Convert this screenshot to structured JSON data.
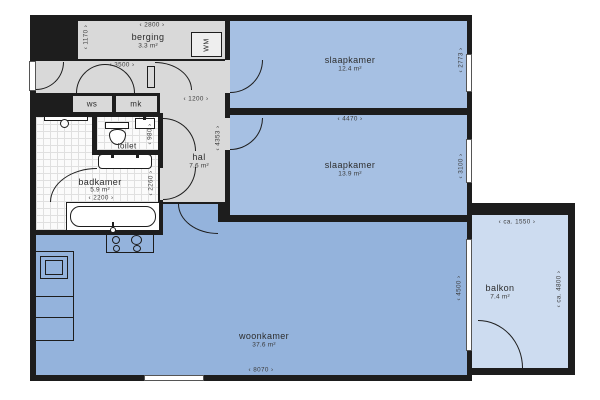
{
  "plan": {
    "rooms": {
      "berging": {
        "name": "berging",
        "area": "3.3 m²"
      },
      "slaapkamer1": {
        "name": "slaapkamer",
        "area": "12.4 m²"
      },
      "slaapkamer2": {
        "name": "slaapkamer",
        "area": "13.9 m²"
      },
      "hal": {
        "name": "hal",
        "area": "7.6 m²"
      },
      "toilet": {
        "name": "toilet"
      },
      "badkamer": {
        "name": "badkamer",
        "area": "5.9 m²"
      },
      "woonkamer": {
        "name": "woonkamer",
        "area": "37.6 m²"
      },
      "balkon": {
        "name": "balkon",
        "area": "7.4 m²"
      },
      "ws": {
        "name": "ws"
      },
      "mk": {
        "name": "mk"
      }
    },
    "dimensions": {
      "berging_width": "‹ 2800 ›",
      "berging_depth": "‹ 1170 ›",
      "entree_width": "‹ 3500 ›",
      "hal_width": "‹ 1200 ›",
      "hal_depth": "‹ 4353 ›",
      "toilet_depth": "‹ 980 ›",
      "badkamer_width": "‹ 2200 ›",
      "badkamer_depth": "‹ 2260 ›",
      "slaapkamer1_depth": "‹ 2773 ›",
      "slaapkamer2_width": "‹ 4470 ›",
      "slaapkamer2_depth": "‹ 3100 ›",
      "woonkamer_width": "‹ 8070 ›",
      "woonkamer_depth": "‹ 4500 ›",
      "balkon_width": "‹ ca. 1550 ›",
      "balkon_depth": "‹ ca. 4800 ›"
    },
    "appliances": {
      "washing_machine": "WM"
    },
    "colors": {
      "wall": "#1d1d1d",
      "room_blue": "#a6c0e3",
      "living_blue": "#94b3dc",
      "balcony_blue": "#cddcf0",
      "hall_grey": "#d9d9d9",
      "tile_white": "#fbfbfb"
    }
  }
}
